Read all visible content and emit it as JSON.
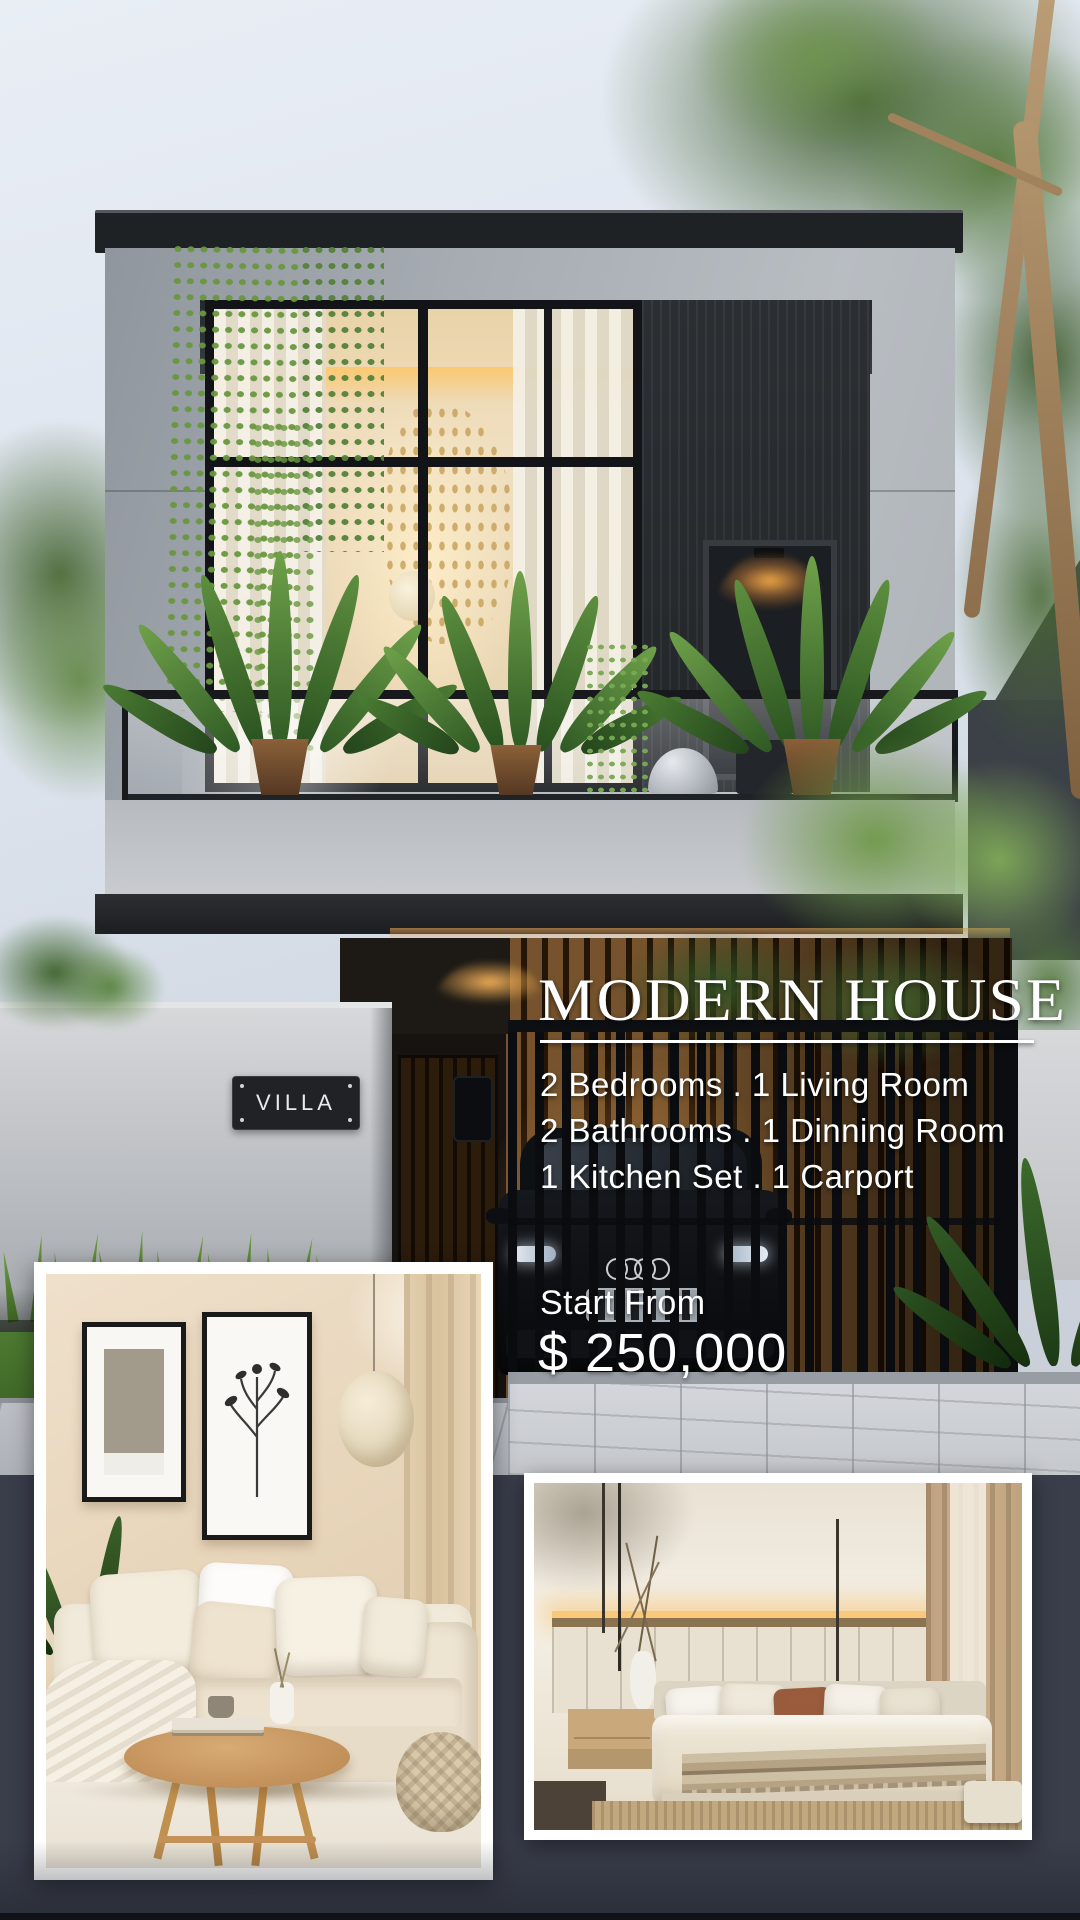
{
  "poster": {
    "title": "MODERN HOUSE",
    "features": [
      "2 Bedrooms . 1 Living Room",
      "2 Bathrooms . 1 Dinning Room",
      "1 Kitchen Set . 1 Carport"
    ],
    "pricing": {
      "label": "Start From",
      "value": "$ 250,000"
    },
    "wall_sign": "VILLA",
    "colors": {
      "background": "#3a3e4b",
      "text": "#ffffff",
      "plaque": "#202225",
      "warm_light": "#f2a94e",
      "foliage": "#4a7c33",
      "facade_gray": "#a9afb5"
    }
  }
}
